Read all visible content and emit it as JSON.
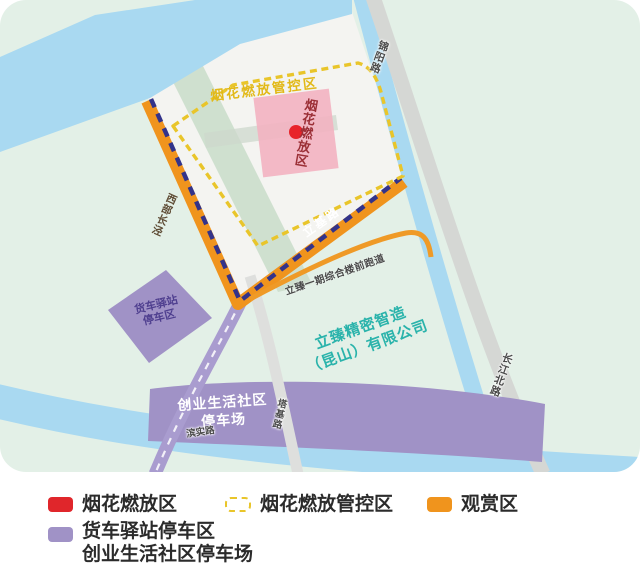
{
  "map": {
    "labels": {
      "control_zone": "烟花燃放管控区",
      "fireworks_zone": "烟花燃放区",
      "company_line1": "立臻精密智造",
      "company_line2": "（昆山）有限公司",
      "truck_parking_line1": "货车驿站",
      "truck_parking_line2": "停车区",
      "community_parking_line1": "创业生活社区",
      "community_parking_line2": "停车场",
      "roads": {
        "jinyang": "锦阳路",
        "changjiangbei": "长江北路",
        "xibuchangjing": "西部长泾",
        "liji": "立基路",
        "runway": "立臻一期综合楼前跑道",
        "taji": "塔基路",
        "binshi": "滨实路"
      }
    },
    "colors": {
      "background_mint": "#e3f0e7",
      "water_blue": "#a9d9f1",
      "plot_white": "#f4f4f1",
      "greenbelt": "#cfe0cf",
      "road_gray": "#d5d7d4",
      "orange_zone": "#f0941d",
      "navy_dash": "#33338a",
      "control_dash_yellow": "#e9c52a",
      "fireworks_pink": "#f3b2c1",
      "fireworks_red": "#e8232a",
      "parking_purple": "#a092c6",
      "company_teal": "#2ab3ab"
    }
  },
  "legend": {
    "items": [
      {
        "label": "烟花燃放区",
        "color": "#e0262b",
        "style": "solid"
      },
      {
        "label": "烟花燃放管控区",
        "color": "#e9c52a",
        "style": "dashed-outline"
      },
      {
        "label": "观赏区",
        "color": "#f0941d",
        "style": "solid"
      },
      {
        "label_line1": "货车驿站停车区",
        "label_line2": "创业生活社区停车场",
        "color": "#a092c6",
        "style": "solid"
      }
    ]
  }
}
